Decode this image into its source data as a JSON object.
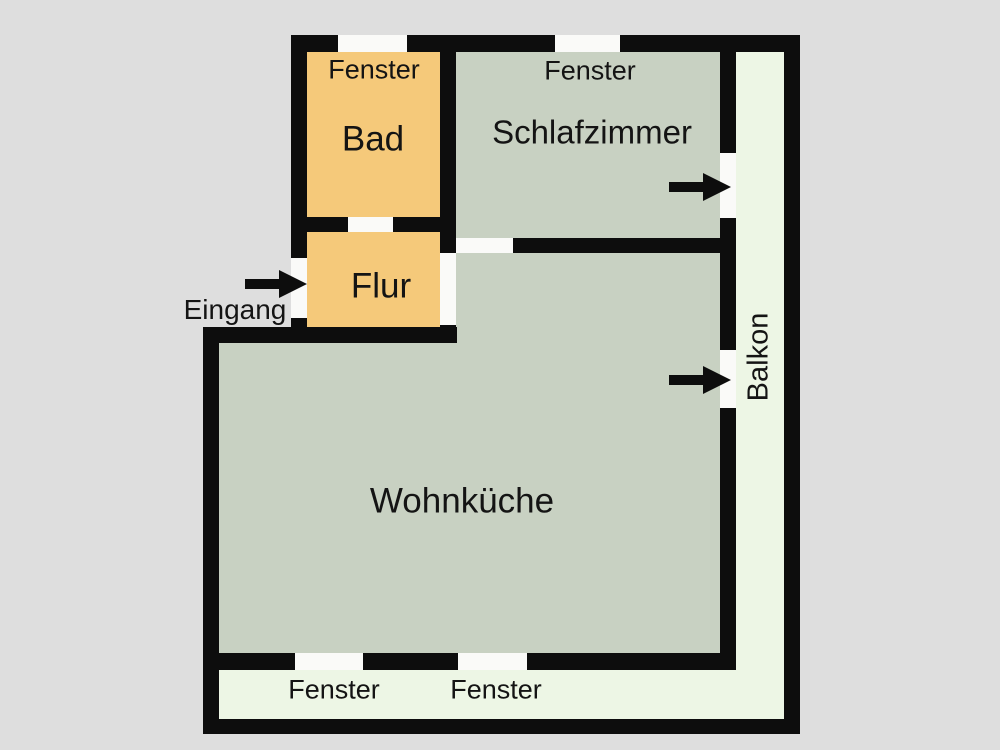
{
  "colors": {
    "background": "#dedede",
    "wall": "#0d0d0d",
    "bathroom": "#f5c97a",
    "room": "#c8d1c2",
    "balcony": "#edf6e5",
    "opening": "#fafaf8",
    "text": "#141414"
  },
  "rooms": {
    "bad": {
      "label": "Bad"
    },
    "schlafzimmer": {
      "label": "Schlafzimmer"
    },
    "flur": {
      "label": "Flur"
    },
    "wohnkueche": {
      "label": "Wohnküche"
    },
    "balkon": {
      "label": "Balkon"
    }
  },
  "annotations": {
    "eingang": {
      "label": "Eingang"
    },
    "fenster_top_bad": {
      "label": "Fenster"
    },
    "fenster_top_schlafzimmer": {
      "label": "Fenster"
    },
    "fenster_bottom_left": {
      "label": "Fenster"
    },
    "fenster_bottom_right": {
      "label": "Fenster"
    }
  }
}
